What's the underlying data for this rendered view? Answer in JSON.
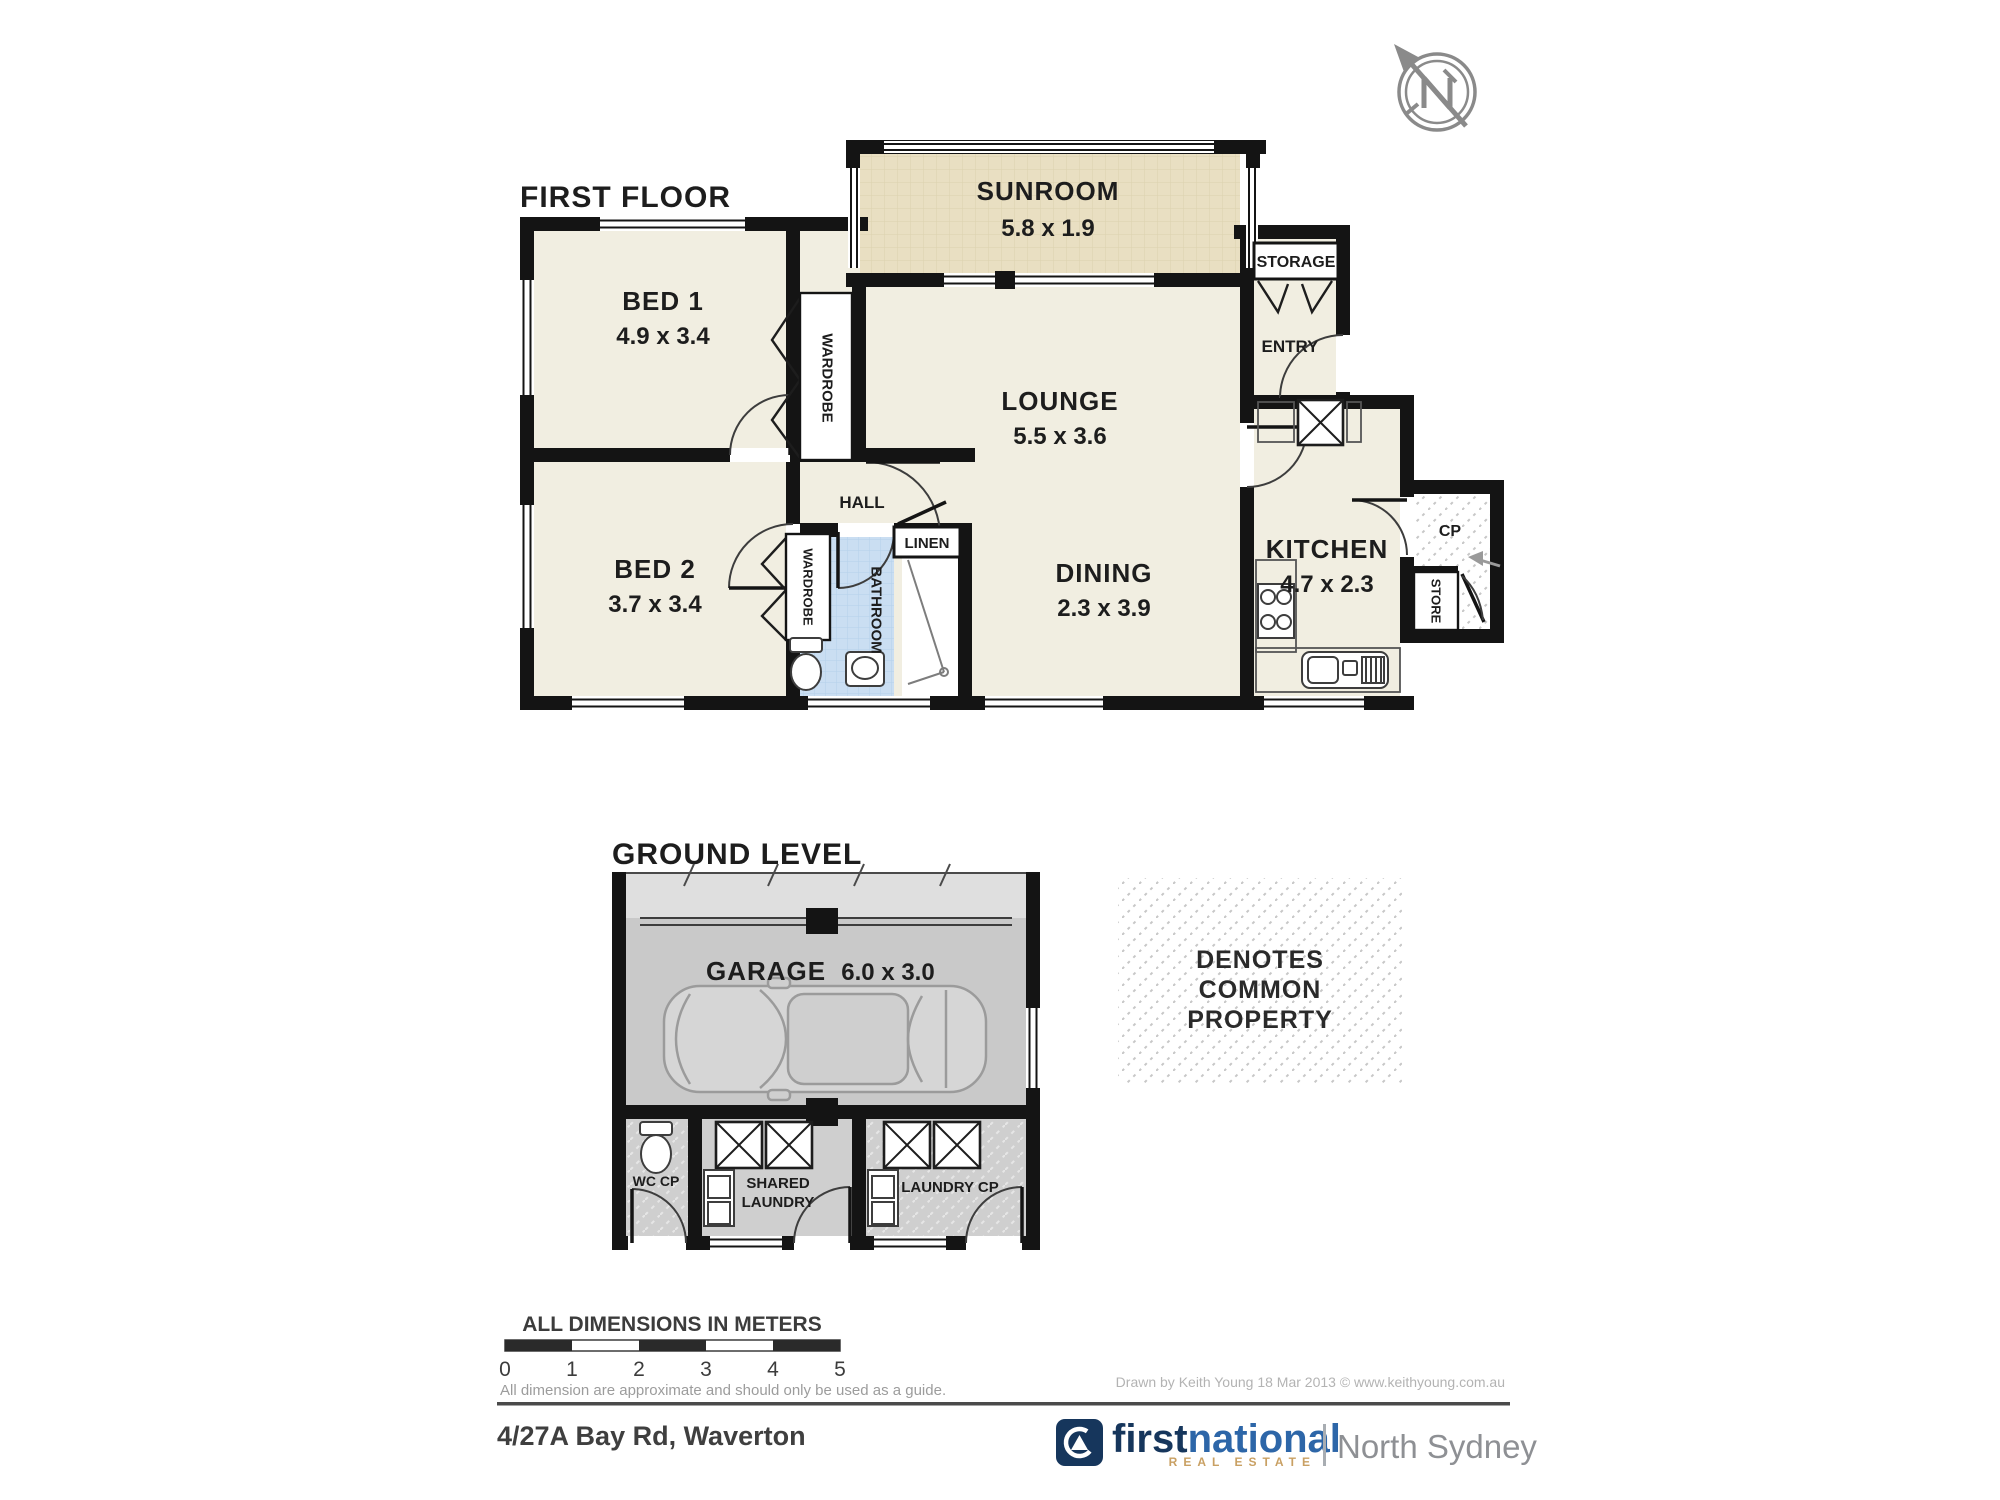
{
  "first_floor": {
    "title": "FIRST FLOOR",
    "sunroom_label": "SUNROOM",
    "sunroom_dims": "5.8  x 1.9",
    "bed1_label": "BED 1",
    "bed1_dims": "4.9 x 3.4",
    "bed2_label": "BED 2",
    "bed2_dims": "3.7 x 3.4",
    "lounge_label": "LOUNGE",
    "lounge_dims": "5.5 x 3.6",
    "dining_label": "DINING",
    "dining_dims": "2.3 x 3.9",
    "kitchen_label": "KITCHEN",
    "kitchen_dims": "4.7 x 2.3",
    "hall_label": "HALL",
    "wardrobe1_label": "WARDROBE",
    "wardrobe2_label": "WARDROBE",
    "bathroom_label": "BATHROOM",
    "linen_label": "LINEN",
    "storage_label": "STORAGE",
    "entry_label": "ENTRY",
    "cp_label": "CP",
    "store_label": "STORE"
  },
  "ground_level": {
    "title": "GROUND LEVEL",
    "garage_label": "GARAGE",
    "garage_dims": "6.0 x 3.0",
    "wc_label": "WC CP",
    "shared_laundry_line1": "SHARED",
    "shared_laundry_line2": "LAUNDRY",
    "laundry_cp_label": "LAUNDRY CP"
  },
  "legend": {
    "line1": "DENOTES",
    "line2": "COMMON",
    "line3": "PROPERTY",
    "scale_title": "ALL DIMENSIONS IN METERS",
    "ticks": [
      "0",
      "1",
      "2",
      "3",
      "4",
      "5"
    ],
    "disclaimer": "All dimension are approximate and should only be used as a guide."
  },
  "footer": {
    "address": "4/27A Bay Rd, Waverton",
    "credit": "Drawn by Keith Young 18 Mar 2013 © www.keithyoung.com.au",
    "brand_word1": "first",
    "brand_word2": "national",
    "brand_tagline": "REAL ESTATE",
    "brand_office": "North Sydney"
  },
  "colors": {
    "room_fill": "#f1eee1",
    "sunroom_fill": "#e9dfc2",
    "bathroom_fill": "#cadef2",
    "garage_fill": "#c9c9c9",
    "laundry_fill": "#cfcfcf",
    "driveway_fill": "#dfdfdf",
    "wall": "#141414",
    "brand_navy": "#16365c",
    "brand_blue": "#2d66a8",
    "brand_gold": "#c9a063",
    "brand_office_gray": "#8e9094"
  }
}
